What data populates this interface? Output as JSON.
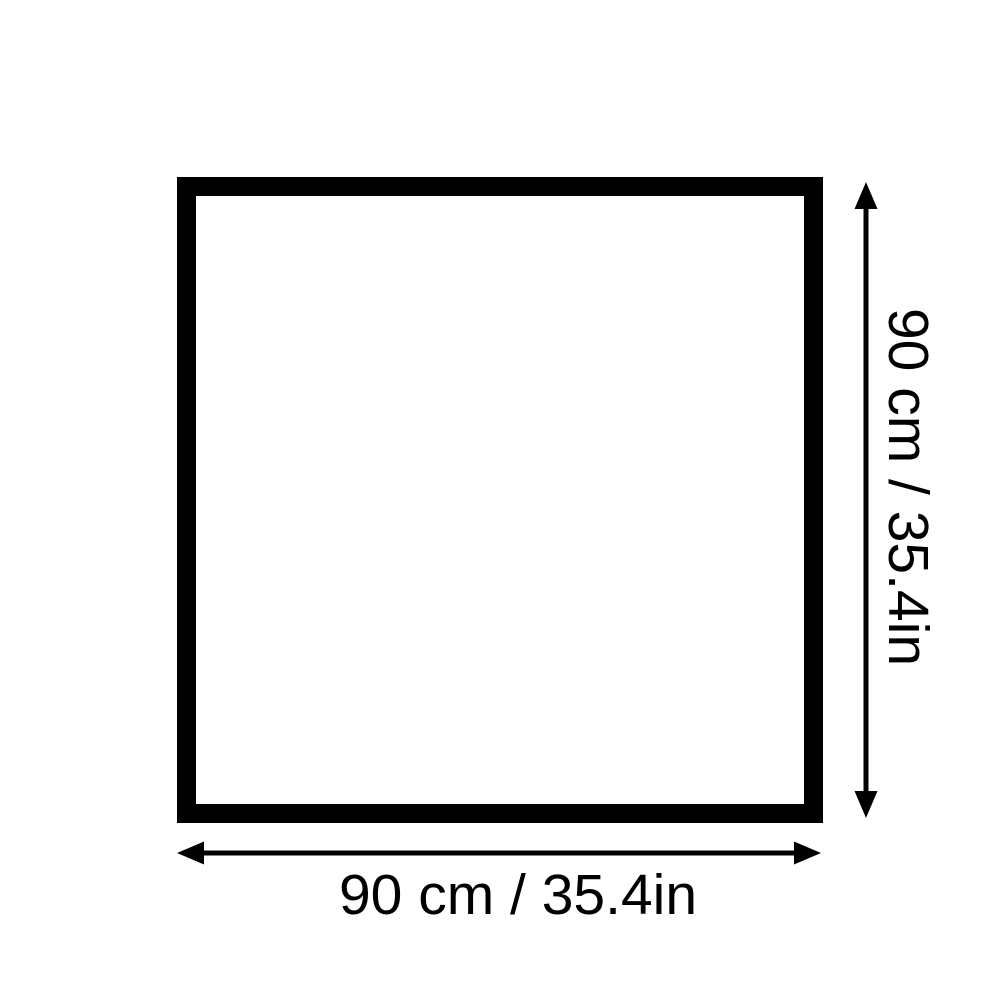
{
  "diagram": {
    "type": "product-dimensions",
    "shape": "square",
    "height_label": "90 cm / 35.4in",
    "width_label": "90 cm / 35.4in",
    "colors": {
      "line": "#000000",
      "background": "#ffffff",
      "square_fill": "#ffffff"
    },
    "icons": {
      "vertical_arrow": "double-headed-vertical-arrow",
      "horizontal_arrow": "double-headed-horizontal-arrow"
    }
  }
}
